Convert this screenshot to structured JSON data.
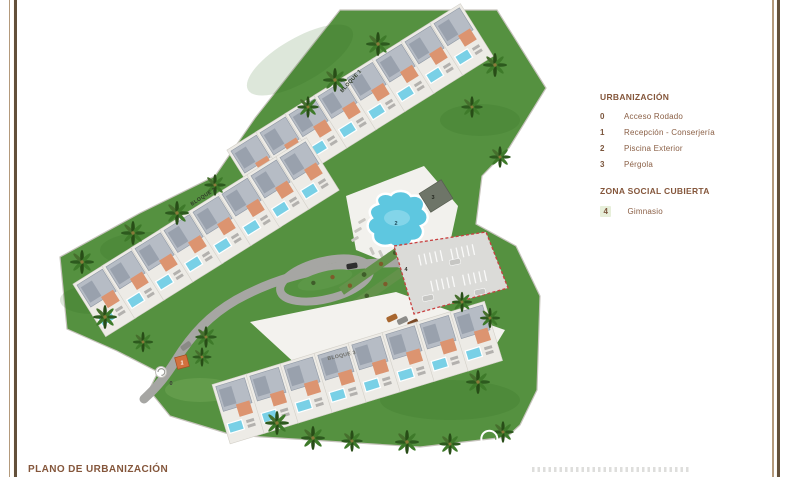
{
  "page": {
    "title": "PLANO DE URBANIZACIÓN"
  },
  "legend": {
    "urbanizacion": {
      "title": "URBANIZACIÓN",
      "items": [
        {
          "num": "0",
          "label": "Acceso Rodado"
        },
        {
          "num": "1",
          "label": "Recepción - Conserjería"
        },
        {
          "num": "2",
          "label": "Piscina Exterior"
        },
        {
          "num": "3",
          "label": "Pérgola"
        }
      ]
    },
    "zona_social": {
      "title": "ZONA SOCIAL CUBIERTA",
      "items": [
        {
          "num": "4",
          "label": "Gimnasio"
        }
      ]
    }
  },
  "map": {
    "blocks": {
      "bloque1": "BLOQUE 1",
      "bloque2": "BLOQUE 2",
      "bloque3": "BLOQUE 3"
    },
    "markers": {
      "m0": "0",
      "m1": "1",
      "m2": "2",
      "m3": "3",
      "m4": "4"
    }
  },
  "colors": {
    "grass": "#559140",
    "palm_dark": "#2d5a1e",
    "pool_blue": "#5ec7e0",
    "terracotta": "#dc9470",
    "roof_gray": "#b6bcc5",
    "road_gray": "#a6a6a3",
    "parking_fill": "#dbdbd8",
    "dashed_outline": "#c94040",
    "legend_text": "#8a5f45",
    "border_line_dark": "#63503a",
    "border_line_light": "#b49a7c"
  }
}
